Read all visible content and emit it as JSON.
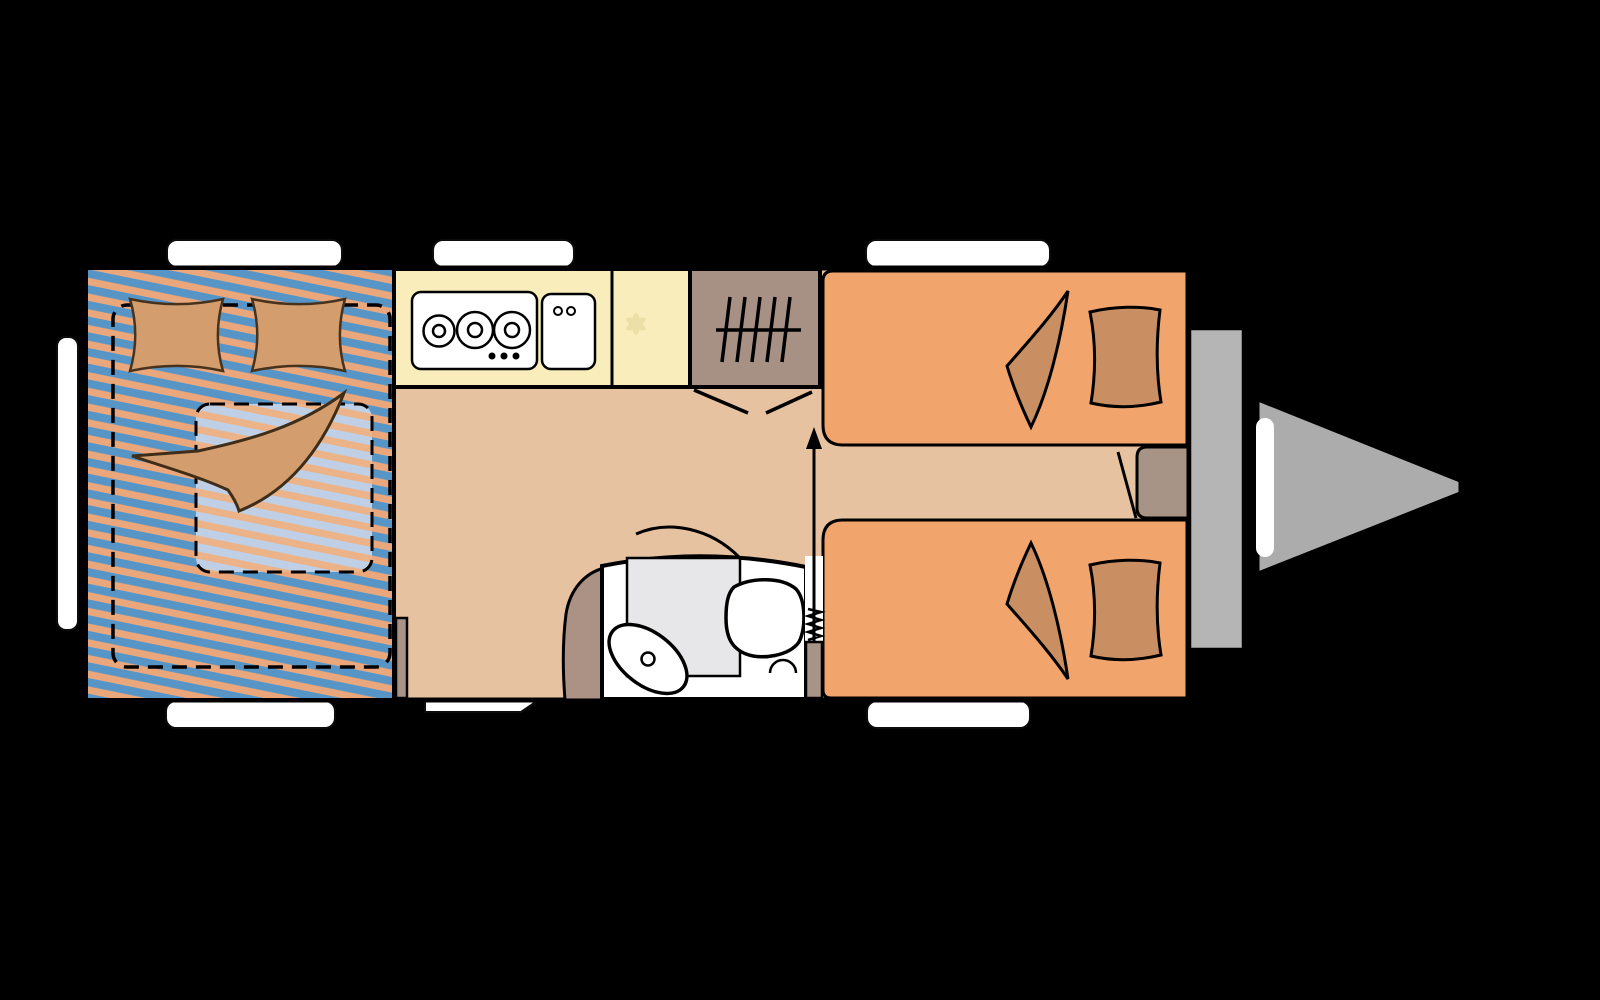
{
  "colors": {
    "background": "#000000",
    "floor": "#e7c2a0",
    "stripe_blue": "#5795c7",
    "stripe_orange": "#eaa77c",
    "stripe_pale_blue": "#bfd0e6",
    "stripe_pale_orange": "#ecb288",
    "kitchen_counter": "#f9eebb",
    "counter_symbol": "#eddfa8",
    "wardrobe": "#a69184",
    "bench": "#f2a46d",
    "cushion": "#c98e61",
    "pillow": "#d49d6e",
    "blanket": "#d49d6e",
    "bathroom_white": "#ffffff",
    "shower_tray": "#e7e7e9",
    "fixture_white": "#ffffff",
    "door_leaf": "#a89486",
    "side_table": "#a89486",
    "bed_step": "#a89486",
    "bathroom_corner": "#ab9285",
    "bumper": "#b5b5b5",
    "drawbar": "#acacac",
    "window": "#ffffff",
    "outline": "#000000"
  },
  "elements": [
    "double-bed",
    "bed-pillow",
    "bed-blanket",
    "mattress",
    "kitchen-hob",
    "kitchen-sink",
    "kitchen-counter",
    "wardrobe-hanging-rail",
    "folding-door",
    "bathroom",
    "shower-tray",
    "washbasin",
    "toilet",
    "bench-seat-top",
    "bench-seat-bottom",
    "seat-cushion",
    "side-table",
    "entrance-door",
    "door-spring",
    "entrance-arrow",
    "window-top-1",
    "window-top-2",
    "window-top-3",
    "window-bottom-1",
    "entry-step",
    "window-bottom-2",
    "window-left",
    "rear-bumper",
    "drawbar-hitch"
  ]
}
